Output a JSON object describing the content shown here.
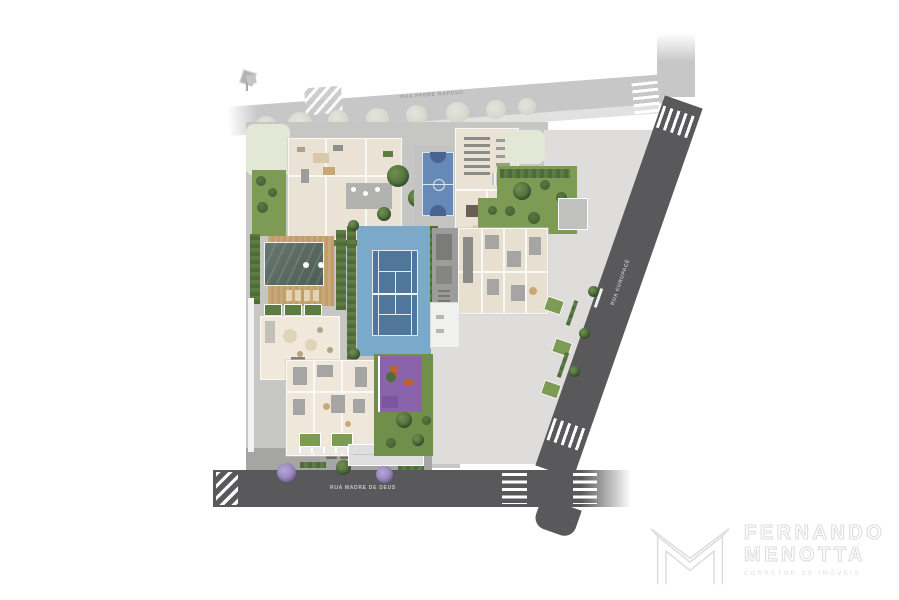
{
  "streets": {
    "top_label": "RUA PADRE RAPOSO",
    "bottom_label": "RUA MADRE DE DEUS",
    "right_label": "RUA CURUPACÊ"
  },
  "watermark": {
    "name_line1": "FERNANDO",
    "name_line2": "MENOTTA",
    "tagline": "CORRETOR DE IMÓVEIS",
    "logo": "faceted-M-monogram",
    "color": "#dcdcdc"
  },
  "site_plan": {
    "type": "architectural masterplan / site implantation illustration, aerial top view",
    "features": [
      "clubhouse",
      "fitness-pavilion",
      "basketball-court",
      "tennis-court",
      "lap-pool",
      "wood-deck",
      "lounge-pavilion",
      "residential-tower-north",
      "residential-tower-south",
      "kids-playground",
      "gardens-and-hedges",
      "driveway-with-planted-islands",
      "vacant-lot",
      "street-crosswalks",
      "parked-cars",
      "flowering-trees",
      "entrance-canopy"
    ],
    "colors": {
      "road_dark": "#59595b",
      "road_light": "#c7c7c8",
      "lot_gray": "#dedddc",
      "site_paving": "#c6c6c4",
      "building_floor": "#eae3d5",
      "lawn_green": "#7e9b55",
      "hedge_green": "#4e6b38",
      "tennis_apron_blue": "#7ba9c9",
      "tennis_court_blue": "#50769b",
      "basketball_blue": "#6789b7",
      "pool_water": "#576860",
      "wood_deck": "#c8a878",
      "playground_purple": "#8a64ab",
      "equipment_orange": "#c06034",
      "flowering_tree_purple": "#9b8abf",
      "watermark_gray": "#dcdcdc"
    }
  }
}
